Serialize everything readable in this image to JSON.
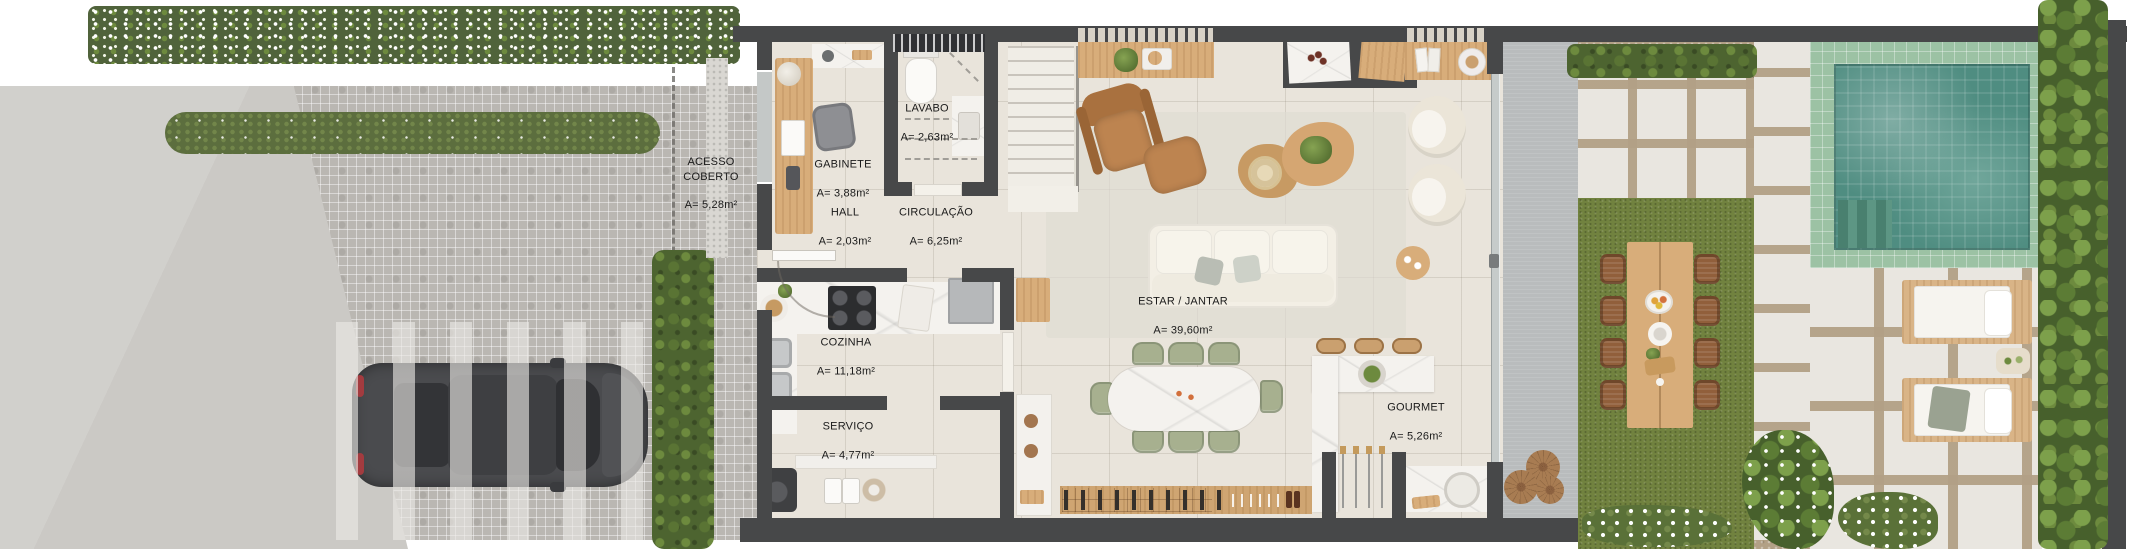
{
  "floorplan": {
    "rooms": [
      {
        "id": "acesso-coberto",
        "name": "ACESSO\nCOBERTO",
        "area": "A= 5,28m²"
      },
      {
        "id": "gabinete",
        "name": "GABINETE",
        "area": "A= 3,88m²"
      },
      {
        "id": "lavabo",
        "name": "LAVABO",
        "area": "A= 2,63m²"
      },
      {
        "id": "hall",
        "name": "HALL",
        "area": "A= 2,03m²"
      },
      {
        "id": "circulacao",
        "name": "CIRCULAÇÃO",
        "area": "A= 6,25m²"
      },
      {
        "id": "cozinha",
        "name": "COZINHA",
        "area": "A= 11,18m²"
      },
      {
        "id": "servico",
        "name": "SERVIÇO",
        "area": "A= 4,77m²"
      },
      {
        "id": "estar-jantar",
        "name": "ESTAR / JANTAR",
        "area": "A= 39,60m²"
      },
      {
        "id": "gourmet",
        "name": "GOURMET",
        "area": "A= 5,26m²"
      }
    ],
    "colors": {
      "wall": "#474849",
      "floor": "#e9e4db",
      "wood": "#d8ad7a",
      "marble": "#f4f2ee",
      "grass": "#71823f",
      "pool_water": "#4f8d81",
      "pool_tile": "#9cc2a4",
      "sage_chair": "#a7b08f",
      "driveway": "#bab7b2",
      "hedge": "#50633b"
    }
  }
}
